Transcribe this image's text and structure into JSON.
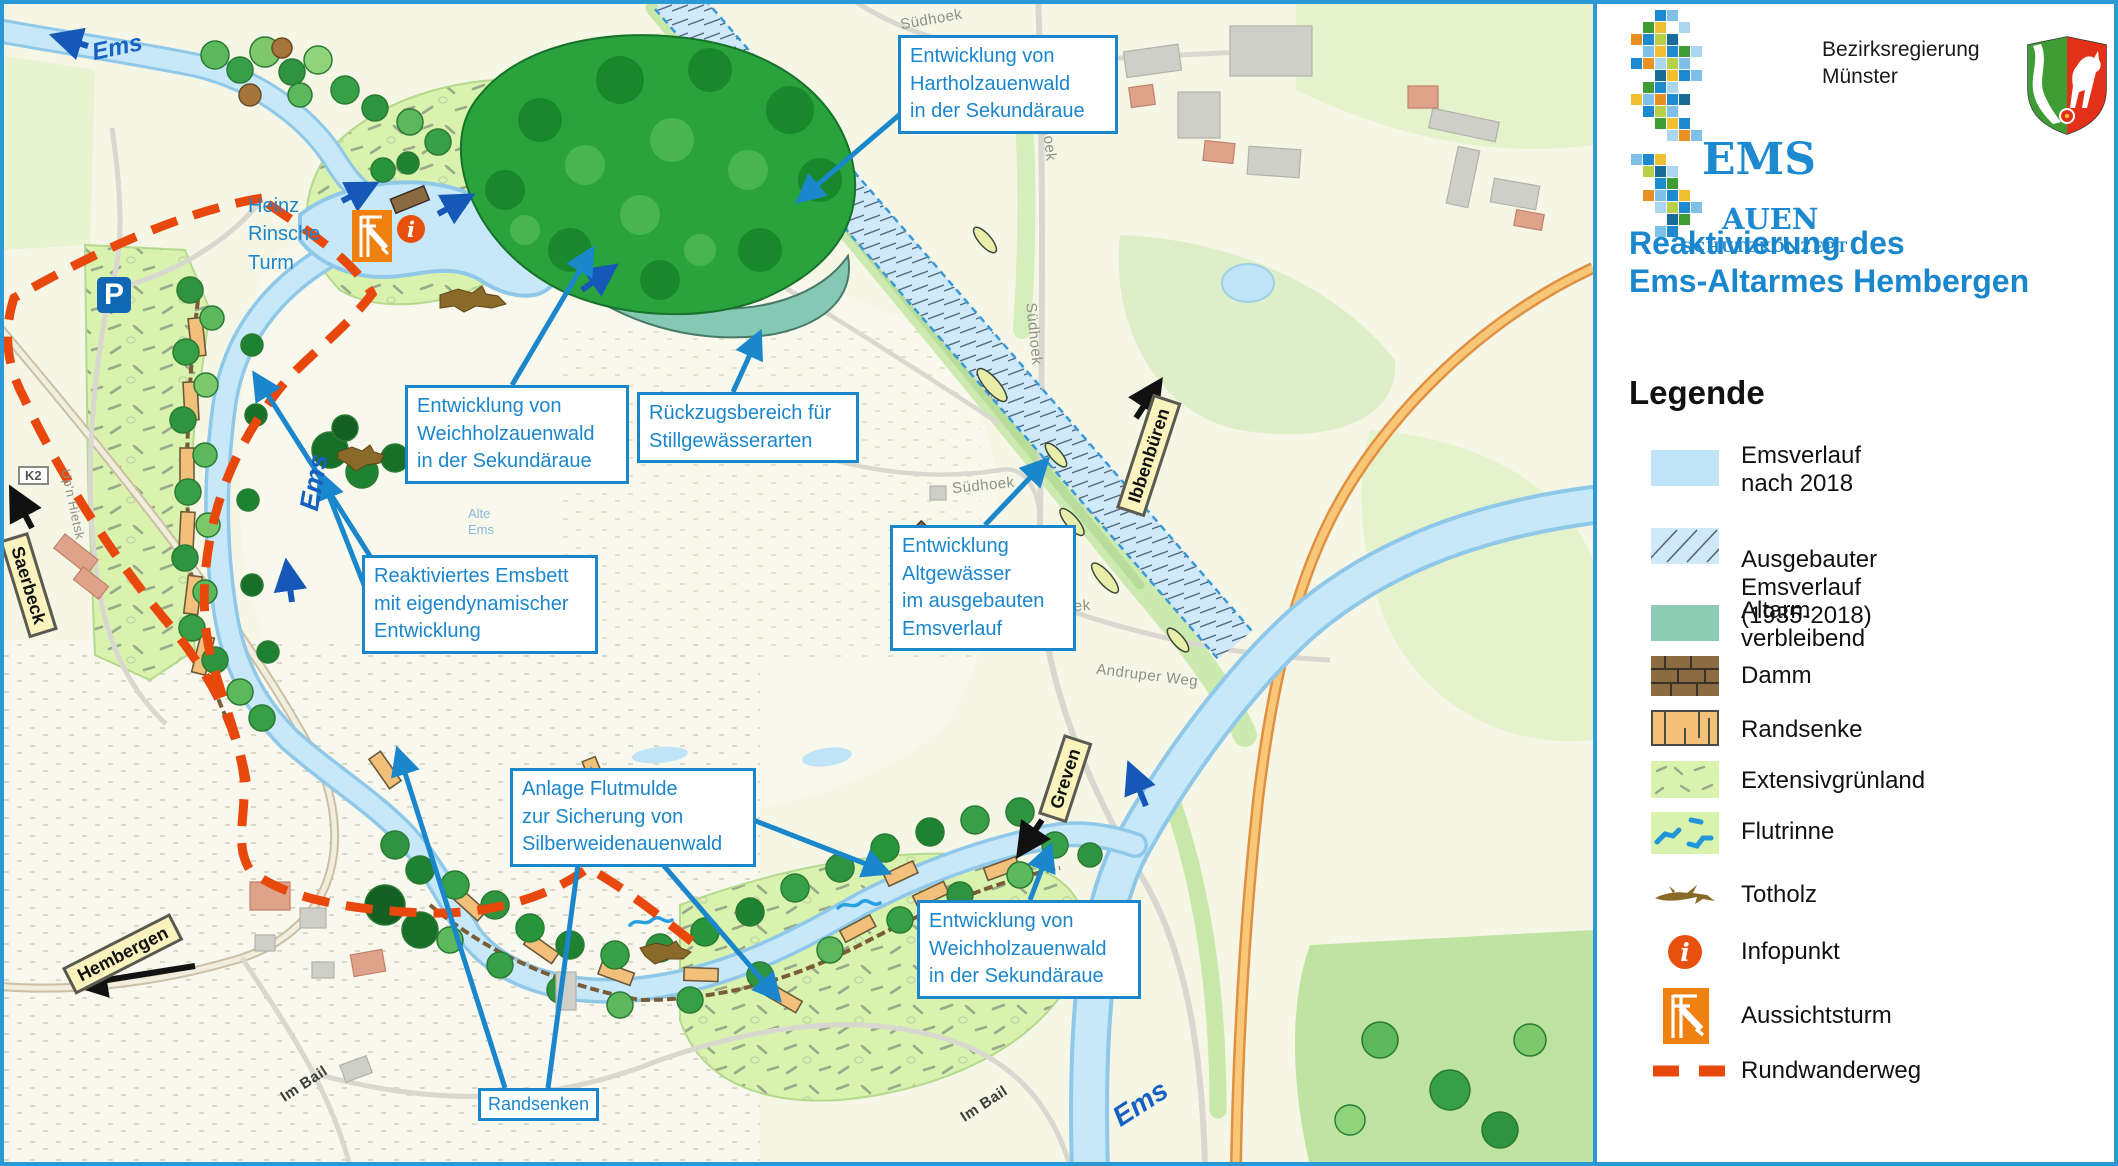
{
  "panel": {
    "org": "Bezirksregierung\nMünster",
    "logo": {
      "ems": "EMS",
      "auen": "AUEN",
      "schutz": "SCHUTZKONZEPT"
    },
    "title": "Reaktivierung des\nEms-Altarmes Hembergen",
    "legend_title": "Legende",
    "legend": [
      {
        "key": "emsverlauf-nach-2018",
        "label": "Emsverlauf nach 2018"
      },
      {
        "key": "ausgebauter-emsverlauf",
        "label": "Ausgebauter Emsverlauf\n(1935-2018)"
      },
      {
        "key": "altarm-verbleibend",
        "label": "Altarm verbleibend"
      },
      {
        "key": "damm",
        "label": "Damm"
      },
      {
        "key": "randsenke",
        "label": "Randsenke"
      },
      {
        "key": "extensivgruenland",
        "label": "Extensivgrünland"
      },
      {
        "key": "flutrinne",
        "label": "Flutrinne"
      },
      {
        "key": "totholz",
        "label": "Totholz"
      },
      {
        "key": "infopunkt",
        "label": "Infopunkt"
      },
      {
        "key": "aussichtsturm",
        "label": "Aussichtsturm"
      },
      {
        "key": "rundwanderweg",
        "label": "Rundwanderweg"
      }
    ]
  },
  "map": {
    "callouts": [
      {
        "id": "hartholz",
        "text": "Entwicklung von\nHartholzauenwald\nin der Sekundäraue"
      },
      {
        "id": "weichholz-top",
        "text": "Entwicklung von\nWeichholzauenwald\nin der Sekundäraue"
      },
      {
        "id": "rueckzugsbereich",
        "text": "Rückzugsbereich für\nStillgewässerarten"
      },
      {
        "id": "altgewaesser",
        "text": "Entwicklung\nAltgewässer\nim ausgebauten\nEmsverlauf"
      },
      {
        "id": "reaktiviertes-emsbett",
        "text": "Reaktiviertes Emsbett\nmit eigendynamischer\nEntwicklung"
      },
      {
        "id": "flutmulde",
        "text": "Anlage Flutmulde\nzur Sicherung von\nSilberweidenauenwald"
      },
      {
        "id": "weichholz-bottom",
        "text": "Entwicklung von\nWeichholzauenwald\nin der Sekundäraue"
      },
      {
        "id": "randsenken",
        "text": "Randsenken"
      }
    ],
    "labels": {
      "ems": "Ems",
      "alte_ems": "Alte\nEms",
      "heinz": "Heinz\nRinsche\nTurm",
      "p": "P",
      "k2": "K2",
      "suedhoek": "Südhoek",
      "andruper": "Andruper Weg",
      "im_bail": "Im Bail",
      "upn": "Up'n Hietsk"
    },
    "signs": {
      "saerbeck": "Saerbeck",
      "hembergen": "Hembergen",
      "ibbenbueren": "Ibbenbüren",
      "greven": "Greven"
    },
    "colors": {
      "callout_blue": "#1a86cc",
      "river_blue": "#c6e8f8",
      "altarm_teal": "#85c9b5",
      "trail_orange": "#e8480c",
      "infopunkt_orange": "#e8500e",
      "tower_orange": "#f08010",
      "flow_arrow_blue": "#1558b8"
    }
  }
}
